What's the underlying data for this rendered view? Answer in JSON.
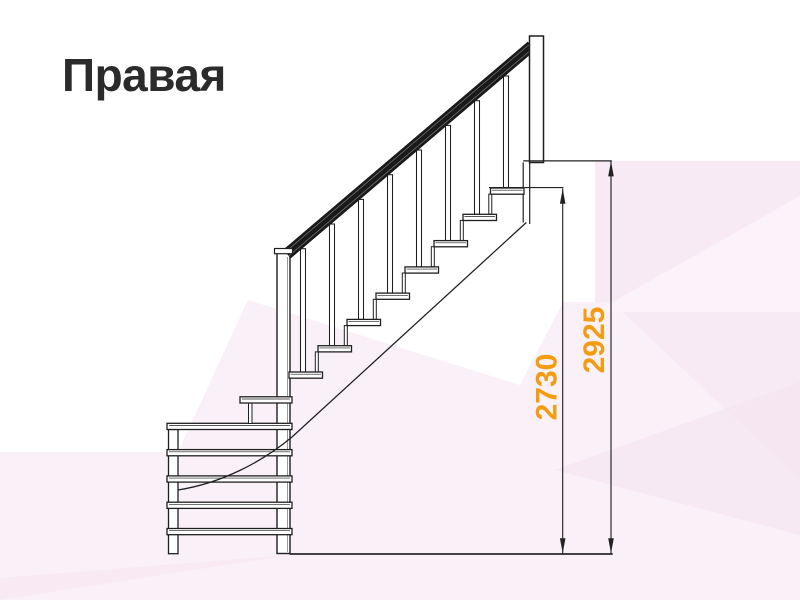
{
  "page": {
    "title": "Правая"
  },
  "diagram": {
    "dimension_labels": [
      "2730",
      "2925"
    ],
    "dimension_color": "#f39c12",
    "line_color": "#1f1f1f",
    "background_tints": [
      "#f7eaf4",
      "#faf0f8",
      "#f3e1ed",
      "#f6e6f1",
      "#fdf4fa"
    ]
  }
}
